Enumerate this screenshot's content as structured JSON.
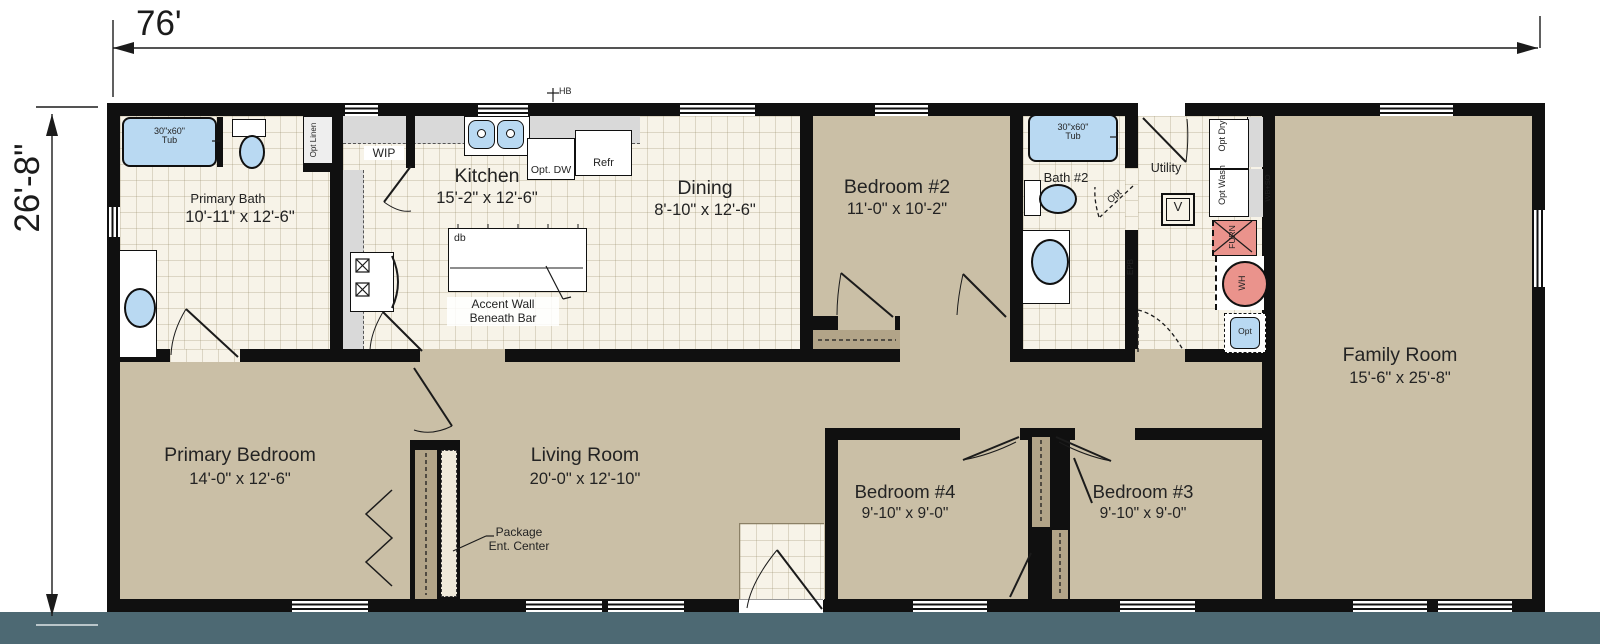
{
  "plan": {
    "overall_width": "76'",
    "overall_height": "26'-8\""
  },
  "rooms": [
    {
      "name": "Primary Bath",
      "dims": "10'-11\" x 12'-6\""
    },
    {
      "name": "Kitchen",
      "dims": "15'-2\" x 12'-6\""
    },
    {
      "name": "Dining",
      "dims": "8'-10\" x 12'-6\""
    },
    {
      "name": "Bedroom #2",
      "dims": "11'-0\" x 10'-2\""
    },
    {
      "name": "Bath #2"
    },
    {
      "name": "Utility"
    },
    {
      "name": "Family Room",
      "dims": "15'-6\" x 25'-8\""
    },
    {
      "name": "Primary Bedroom",
      "dims": "14'-0\" x 12'-6\""
    },
    {
      "name": "Living Room",
      "dims": "20'-0\" x 12'-10\""
    },
    {
      "name": "Bedroom #4",
      "dims": "9'-10\" x 9'-0\""
    },
    {
      "name": "Bedroom #3",
      "dims": "9'-10\" x 9'-0\""
    }
  ],
  "fixtures": {
    "tub_primary_size": "30\"x60\"",
    "tub_primary_label": "Tub",
    "tub_bath2_size": "30\"x60\"",
    "tub_bath2_label": "Tub",
    "opt_linen": "Opt Linen",
    "wip": "WIP",
    "opt_dw": "Opt. DW",
    "refr": "Refr",
    "hose_bib": "HB",
    "island_db": "db",
    "accent_wall_line1": "Accent Wall",
    "accent_wall_line2": "Beneath Bar",
    "opt_dry": "Opt Dry",
    "opt_wash": "Opt Wash",
    "furnace": "FURN",
    "water_heater": "WH",
    "opt_sink": "Opt",
    "vent": "V",
    "epb": "EPB",
    "wb_so": "WB+SO",
    "opt_door": "Opt",
    "package_line1": "Package",
    "package_line2": "Ent. Center"
  },
  "colors": {
    "background": "#ffffff",
    "bottom_band": "#4d6973",
    "wall": "#101010",
    "tile_floor": "#f7f3e8",
    "carpet": "#cabfa6",
    "closet": "#b2a488",
    "counter": "#d9d9d9",
    "fixture_blue": "#b9d9f2",
    "equipment_pink": "#ea938c",
    "text": "#232323"
  }
}
